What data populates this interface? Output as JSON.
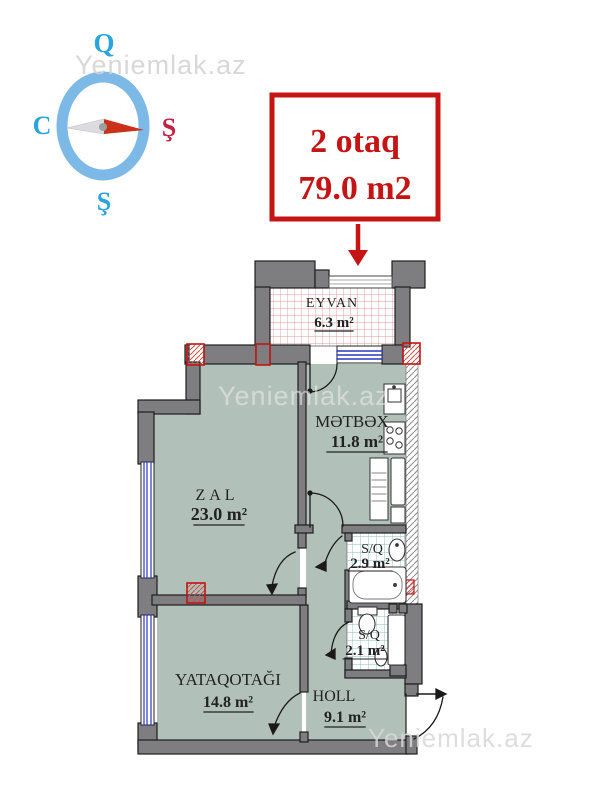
{
  "watermark": {
    "text": "Yeniemlak.az"
  },
  "compass": {
    "north_label": "Q",
    "west_label": "C",
    "east_label": "Ş",
    "south_label": "Ş"
  },
  "banner": {
    "rooms_line": "2 otaq",
    "area_line": "79.0 m2"
  },
  "rooms": {
    "eyvan": {
      "name": "EYVAN",
      "area": "6.3 m²"
    },
    "metbex": {
      "name": "MƏTBƏX",
      "area": "11.8 m²"
    },
    "zal": {
      "name": "ZAL",
      "area": "23.0 m²"
    },
    "sq_big": {
      "name": "S/Q",
      "area": "2.9 m²"
    },
    "sq_small": {
      "name": "S/Q",
      "area": "2.1 m²"
    },
    "yataq": {
      "name": "YATAQOTAĞI",
      "area": "14.8 m²"
    },
    "holl": {
      "name": "HOLL",
      "area": "9.1 m²"
    }
  },
  "colors": {
    "accent_red": "#c41414",
    "wall_gray": "#7e7e80",
    "floor_green": "#b2c0ba",
    "compass_ring_blue": "#7db9e7",
    "compass_letter_blue": "#2aa4dc",
    "window_blue": "#2a35c0"
  }
}
